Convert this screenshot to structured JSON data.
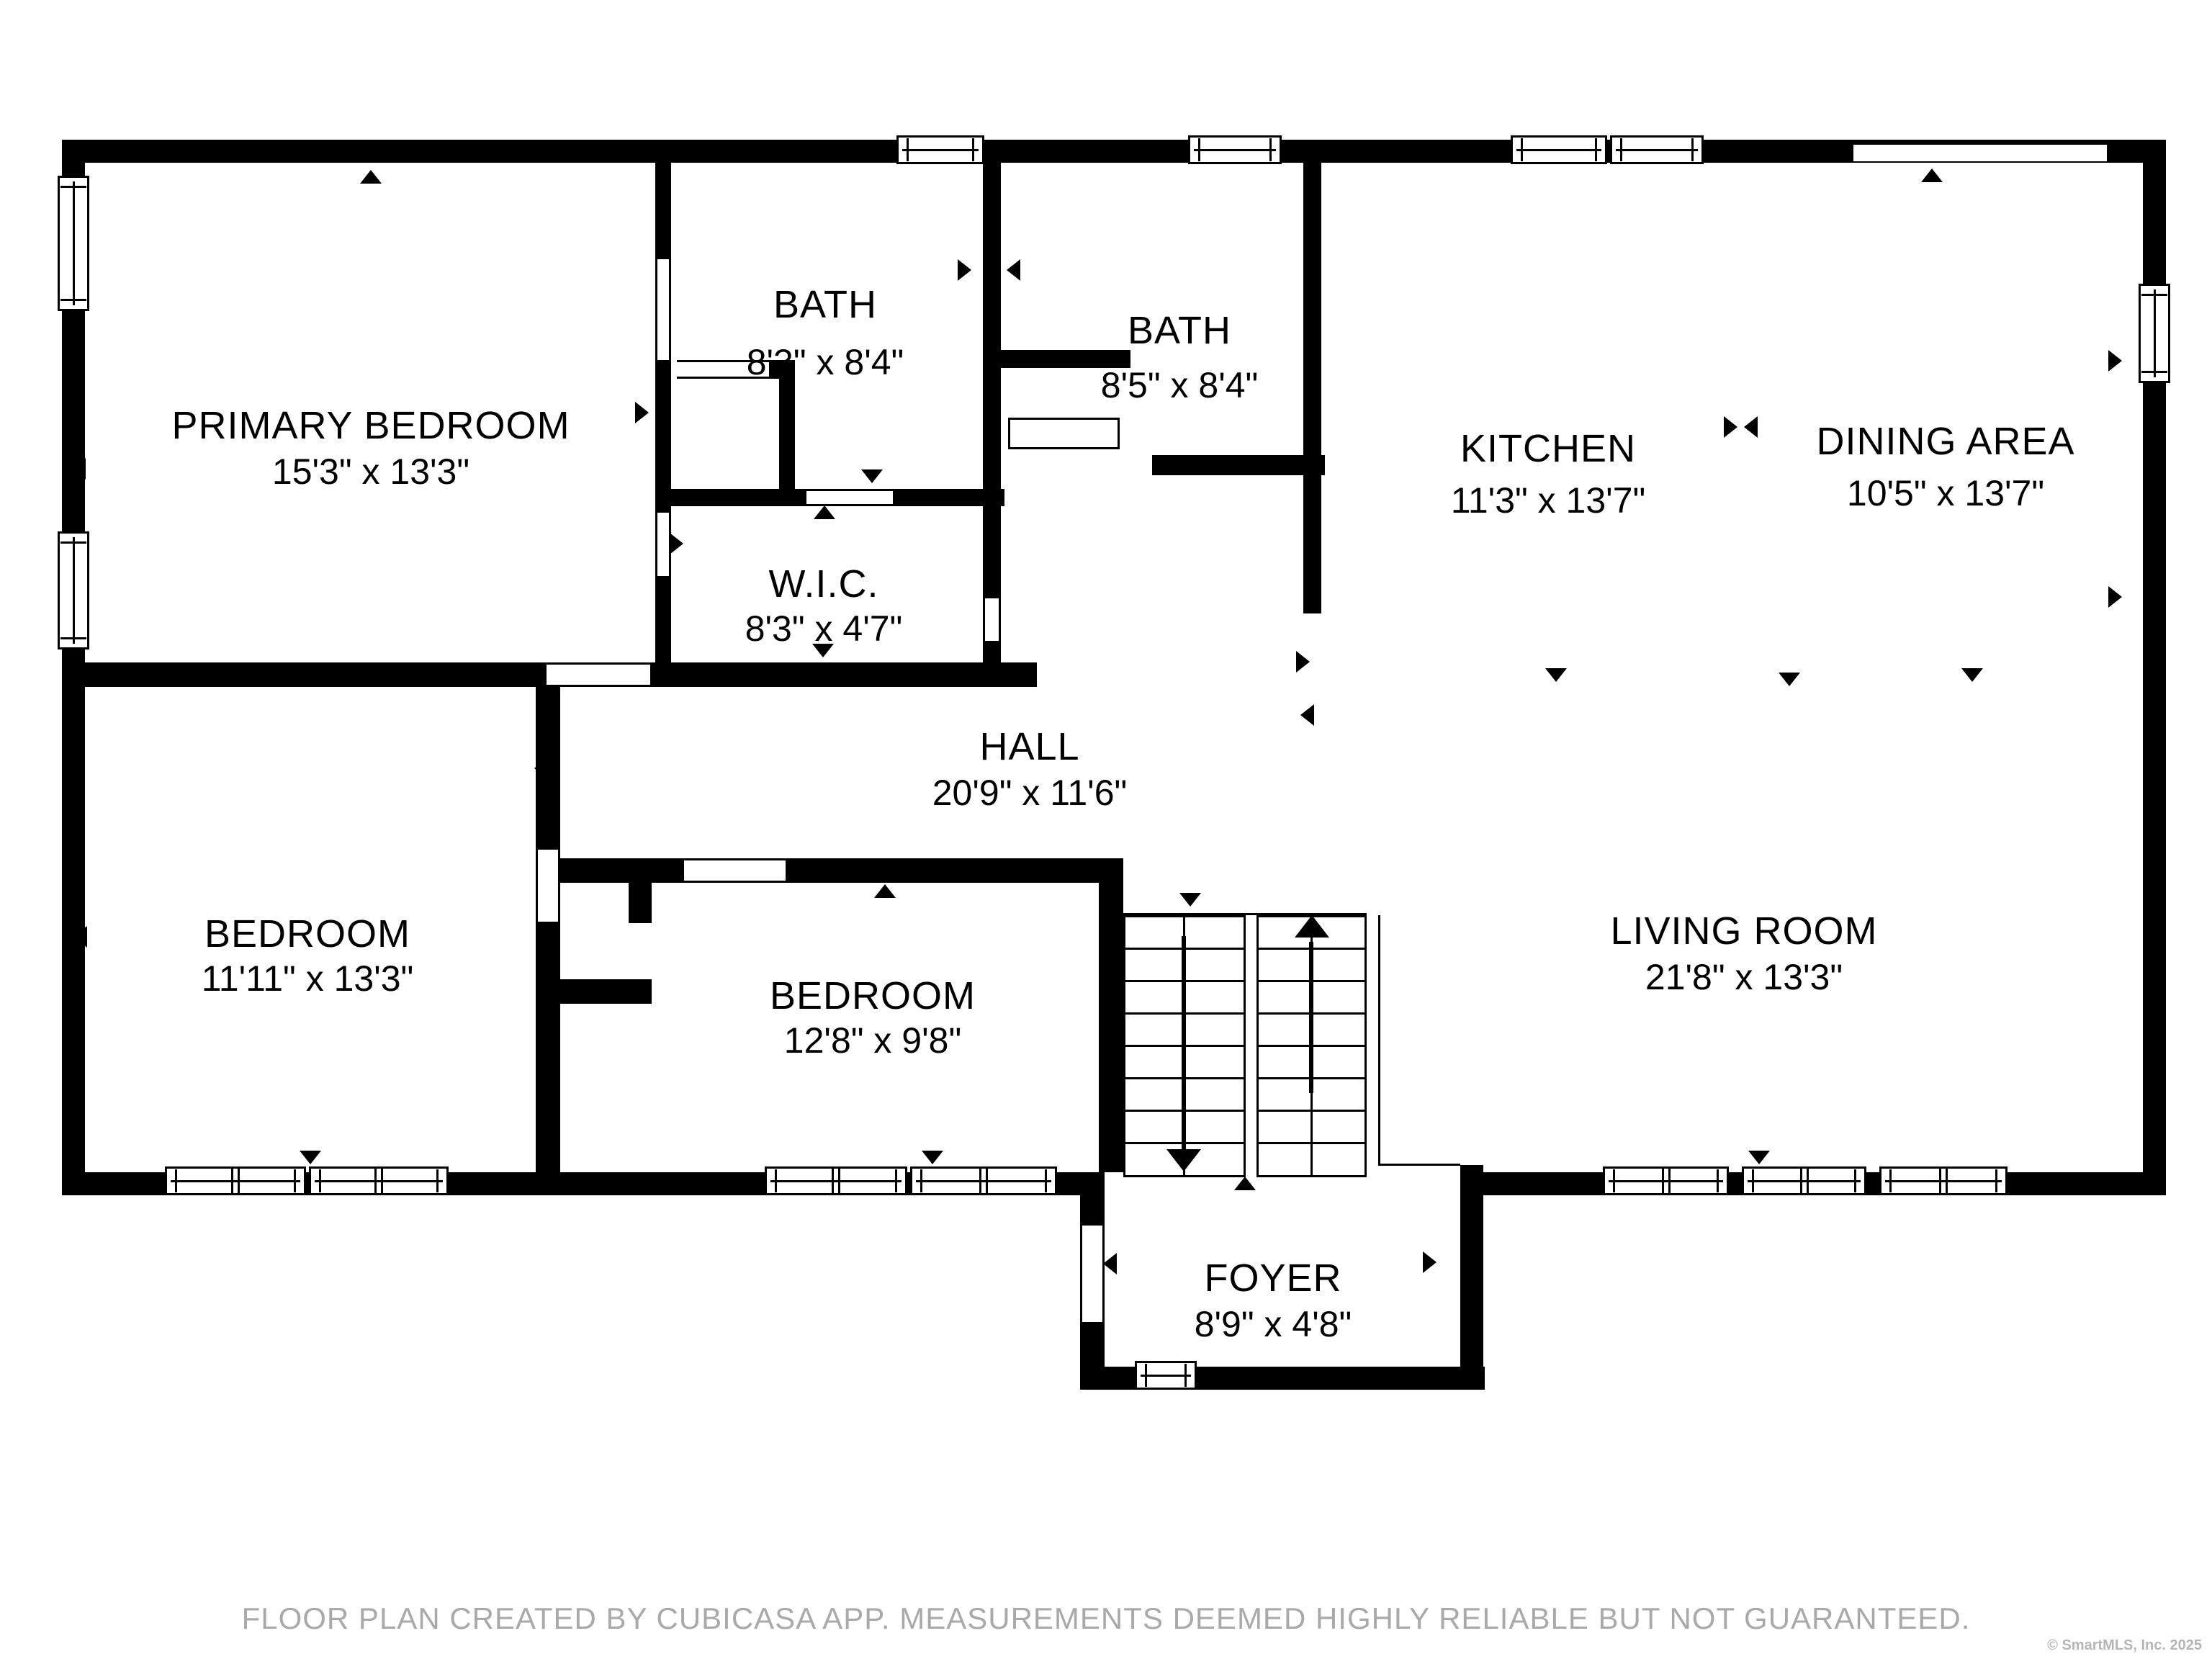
{
  "plan": {
    "rooms": [
      {
        "name": "PRIMARY BEDROOM",
        "dims": "15'3\" x 13'3\""
      },
      {
        "name": "BATH",
        "dims": "8'3\" x 8'4\""
      },
      {
        "name": "BATH",
        "dims": "8'5\" x 8'4\""
      },
      {
        "name": "KITCHEN",
        "dims": "11'3\" x 13'7\""
      },
      {
        "name": "DINING AREA",
        "dims": "10'5\" x 13'7\""
      },
      {
        "name": "W.I.C.",
        "dims": "8'3\" x 4'7\""
      },
      {
        "name": "HALL",
        "dims": "20'9\" x 11'6\""
      },
      {
        "name": "BEDROOM",
        "dims": "11'11\" x 13'3\""
      },
      {
        "name": "BEDROOM",
        "dims": "12'8\" x 9'8\""
      },
      {
        "name": "LIVING ROOM",
        "dims": "21'8\" x 13'3\""
      },
      {
        "name": "FOYER",
        "dims": "8'9\" x 4'8\""
      }
    ],
    "colors": {
      "wall": "#000000",
      "background": "#ffffff",
      "footer_text": "#a9a9a9",
      "copyright_text": "#b5b5b5"
    }
  },
  "footer": {
    "note": "FLOOR PLAN CREATED BY CUBICASA APP. MEASUREMENTS DEEMED HIGHLY RELIABLE BUT NOT GUARANTEED."
  },
  "copyright": {
    "text": "© SmartMLS, Inc. 2025"
  }
}
